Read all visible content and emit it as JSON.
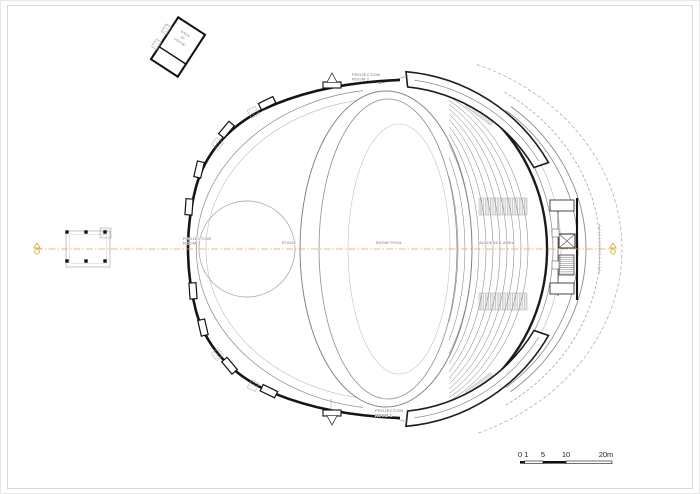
{
  "page": {
    "background": "#ffffff",
    "frame_color": "#cfcfcf"
  },
  "drawing": {
    "ink_color": "#1a1a1a",
    "light_line_color": "#8a8a8a",
    "axis_color": "#e1a83e",
    "labels": {
      "back_of_house": [
        "BACK",
        "OF",
        "HOUSE"
      ],
      "projection_room_2": [
        "PROJECTION",
        "ROOM 2"
      ],
      "projection_room_1": [
        "PROJECTION",
        "ROOM 1"
      ],
      "projection_room_3": [
        "PROJECTION",
        "ROOM 3"
      ],
      "stage": "STAGE",
      "show_pool": "SHOW POOL",
      "audience_area": "AUDIENCE AREA"
    },
    "scale_bar": {
      "ticks": [
        "0",
        "1",
        "5",
        "10",
        "20m"
      ]
    }
  }
}
